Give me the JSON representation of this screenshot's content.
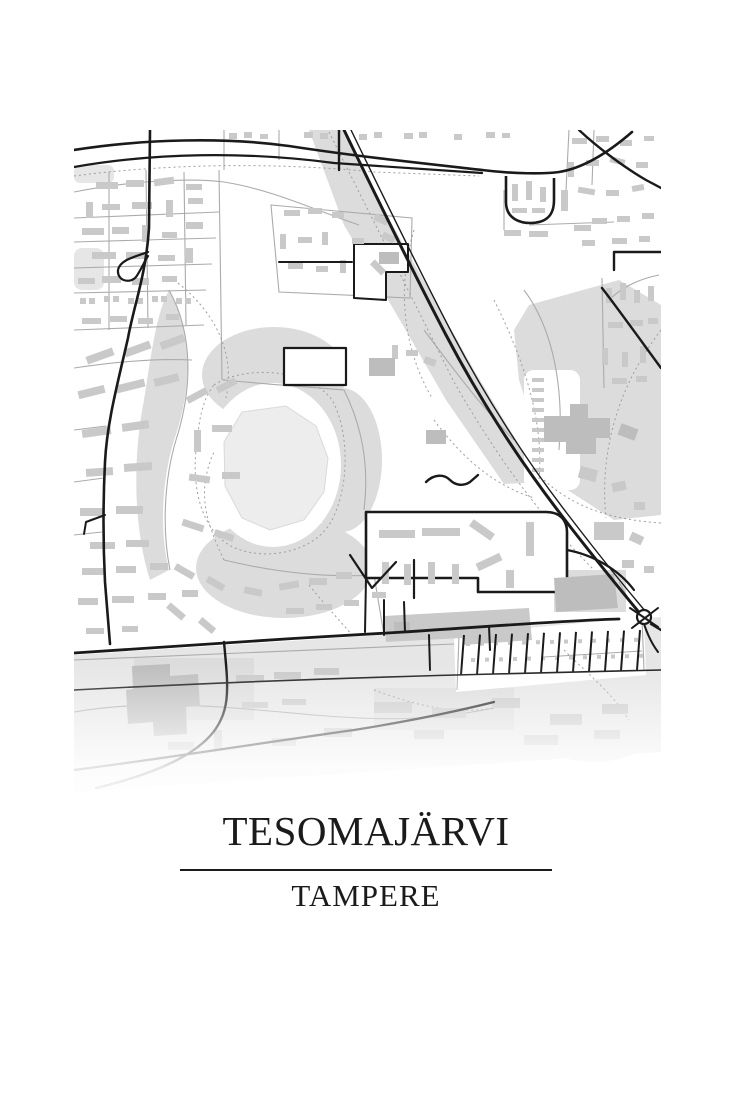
{
  "poster": {
    "title": "TESOMAJÄRVI",
    "subtitle": "TAMPERE"
  },
  "map": {
    "style": "minimal-monochrome-street-map",
    "colors": {
      "background": "#ffffff",
      "park": "#dcdcdc",
      "park_light": "#e6e6e6",
      "water": "#ededed",
      "building": "#c9c9c9",
      "building_dark": "#bdbdbd",
      "road_major": "#1a1a1a",
      "road_minor": "#ababab",
      "path_dotted": "#9e9e9e",
      "text": "#1b1b1b"
    }
  }
}
